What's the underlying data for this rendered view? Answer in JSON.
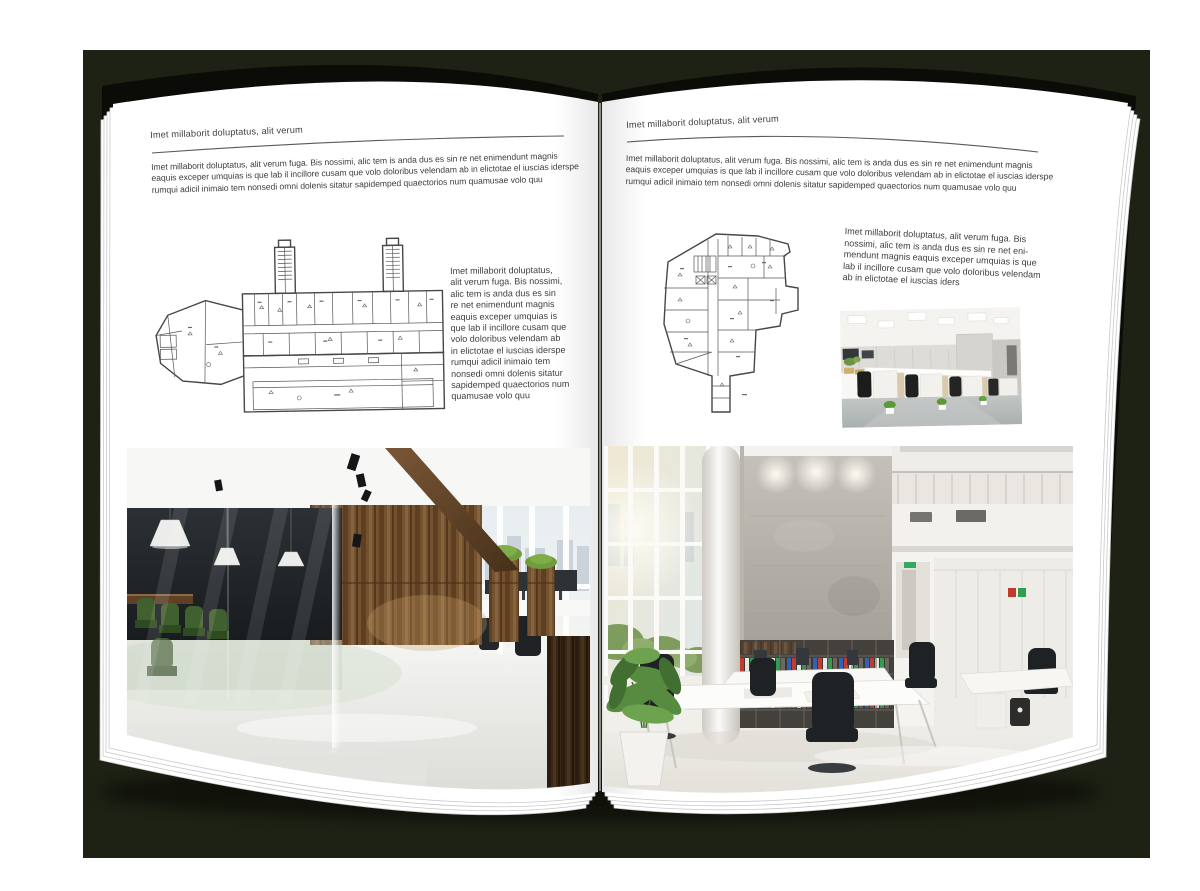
{
  "colors": {
    "backdrop": "#1e2214",
    "book_cover": "#0b0c07",
    "page": "#ffffff",
    "body_text": "#3e3e3e",
    "rule": "#5a5a5a"
  },
  "left_page": {
    "header": "Imet millaborit doluptatus, alit verum",
    "intro_lines": [
      "Imet millaborit doluptatus, alit verum fuga. Bis nossimi, alic tem is anda dus es sin re net enimendunt magnis",
      "eaquis exceper umquias is que lab il incillore cusam que volo doloribus velendam ab in elictotae el iuscias iderspe",
      "rumqui adicil inimaio tem nonsedi omni dolenis sitatur sapidemped quaectorios num quamusae volo quu"
    ],
    "caption_lines": [
      "Imet millaborit doluptatus,",
      "alit verum fuga. Bis nossimi,",
      "alic tem is anda dus es sin",
      "re net enimendunt magnis",
      "eaquis exceper umquias is",
      "que lab il incillore cusam que",
      "volo doloribus velendam ab",
      "in elictotae el iuscias iderspe",
      "rumqui adicil inimaio tem",
      "nonsedi omni dolenis sitatur",
      "sapidemped quaectorios num",
      "quamusae volo quu"
    ],
    "floorplan_label": "floor-plan-wide-building",
    "photo_label": "loft-office-interior-photo"
  },
  "right_page": {
    "header": "Imet millaborit doluptatus, alit verum",
    "intro_lines": [
      "Imet millaborit doluptatus, alit verum fuga. Bis nossimi, alic tem is anda dus es sin re net enimendunt magnis",
      "eaquis exceper umquias is que lab il incillore cusam que volo doloribus velendam ab in elictotae el iuscias iderspe",
      "rumqui adicil inimaio tem nonsedi omni dolenis sitatur sapidemped quaectorios num quamusae volo quu"
    ],
    "caption_lines": [
      "Imet millaborit doluptatus, alit verum fuga. Bis",
      "nossimi, alic tem is anda dus es sin re net eni-",
      "mendunt magnis eaquis exceper umquias is que",
      "lab il incillore cusam que volo doloribus velendam",
      "ab in elictotae el iuscias iders"
    ],
    "floorplan_label": "floor-plan-tower-building",
    "photo_small_label": "open-office-cubicles-photo",
    "photo_label": "bright-atrium-office-photo"
  }
}
